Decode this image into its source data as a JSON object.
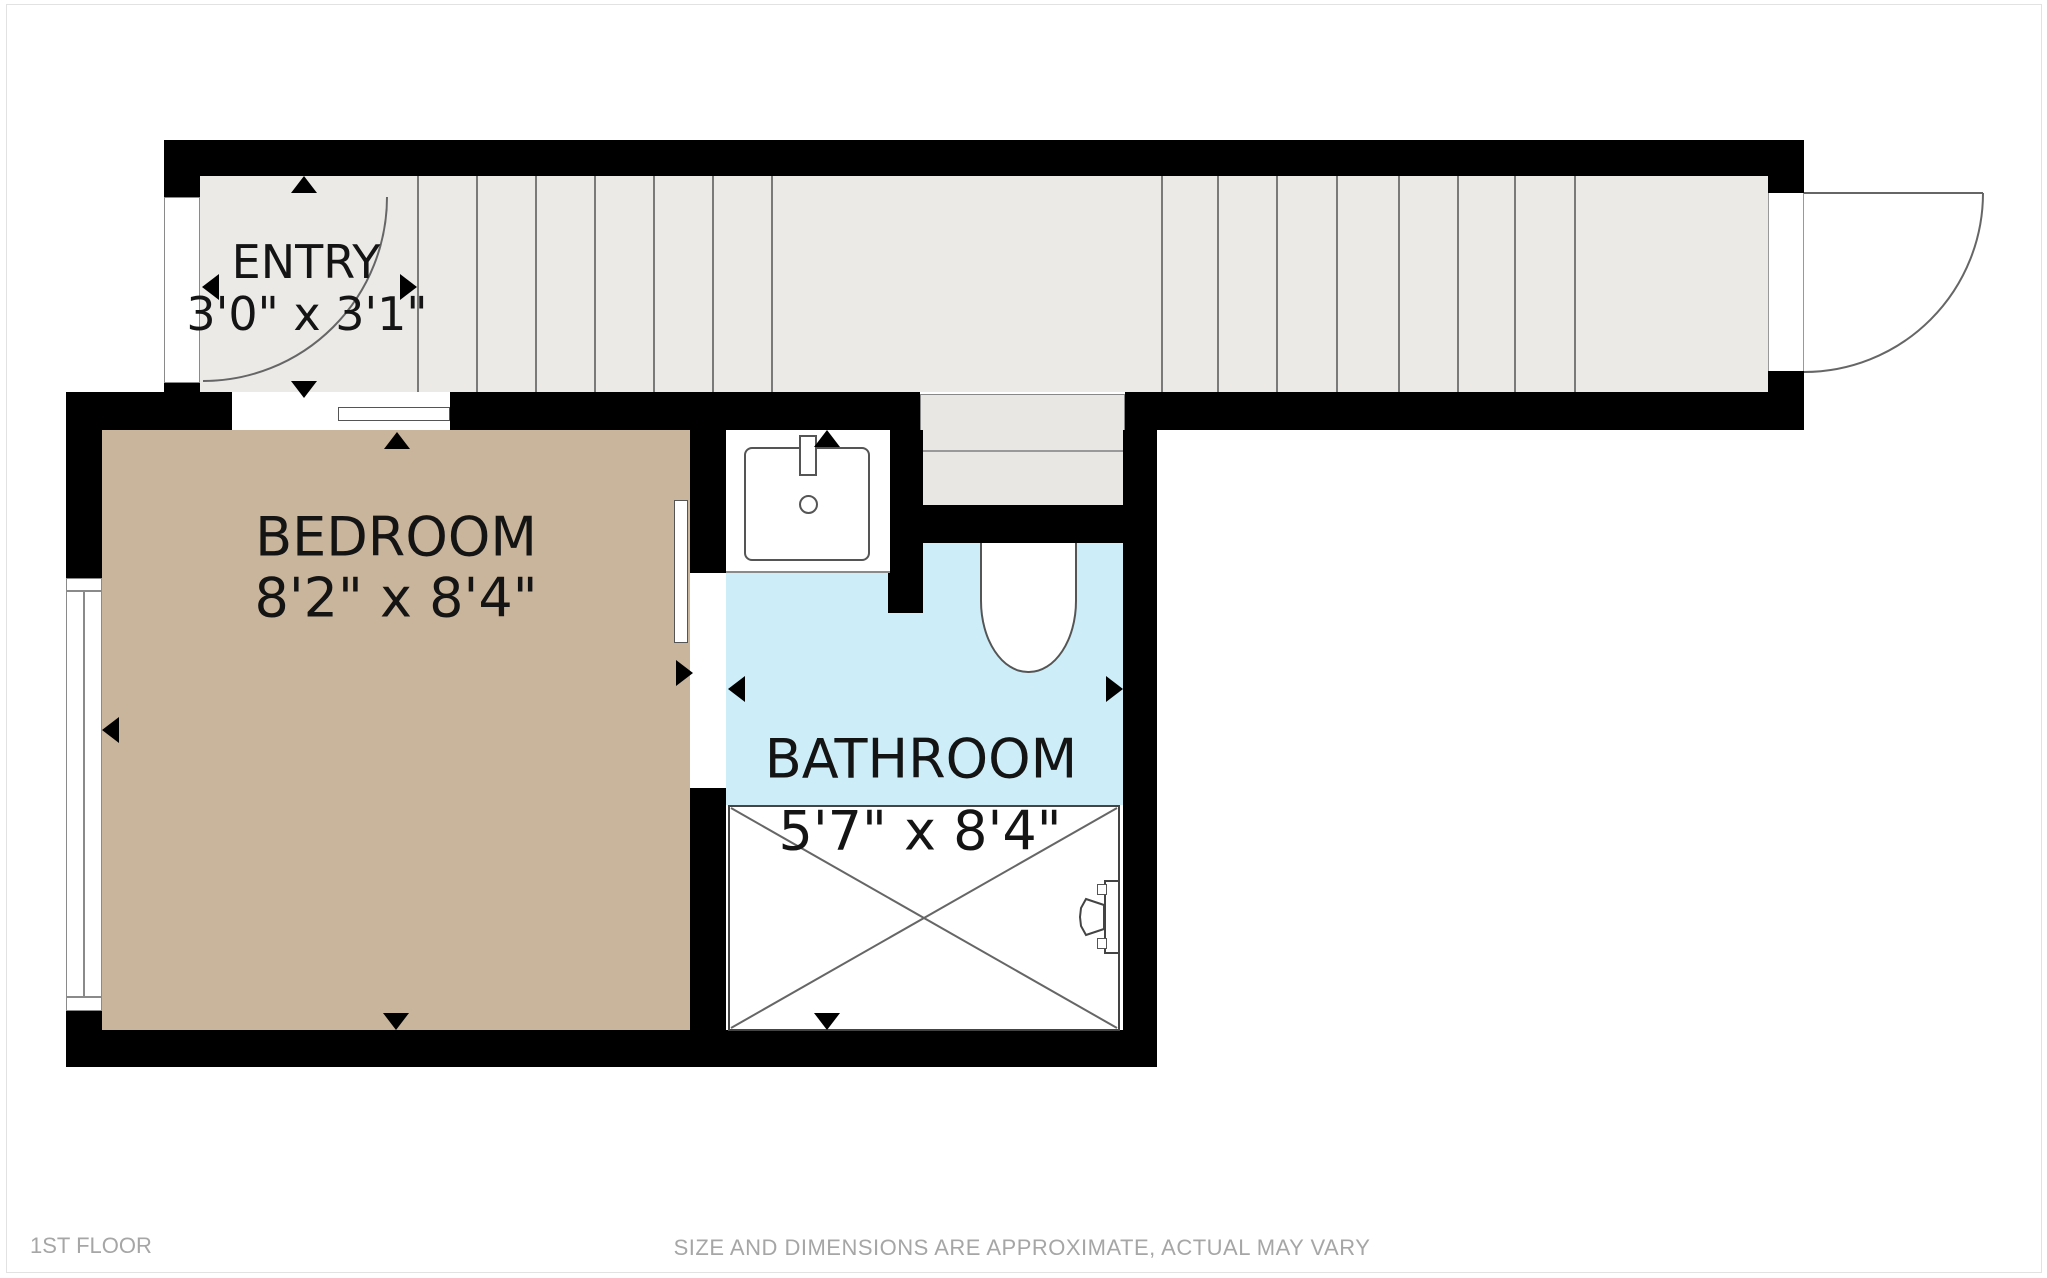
{
  "plan": {
    "rooms": [
      {
        "name": "ENTRY",
        "dims": "3'0\" x 3'1\""
      },
      {
        "name": "BEDROOM",
        "dims": "8'2\" x 8'4\""
      },
      {
        "name": "BATHROOM",
        "dims": "5'7\" x 8'4\""
      }
    ],
    "icons": [
      "stairs-icon",
      "entry-door-swing-icon",
      "exterior-door-swing-icon",
      "sliding-door-icon",
      "pocket-door-icon",
      "sink-icon",
      "toilet-icon",
      "shower-icon",
      "shower-valve-icon",
      "window-icon",
      "dimension-arrow-icon"
    ]
  },
  "footer": {
    "floor_label": "1ST FLOOR",
    "disclaimer": "SIZE AND DIMENSIONS ARE APPROXIMATE, ACTUAL MAY VARY"
  },
  "colors": {
    "bg": "#ffffff",
    "wall": "#000000",
    "corridor": "#eceae7",
    "bedroom": "#c9b49c",
    "bathroom": "#cdeef8",
    "steps": "#e8e7e4",
    "text": "#141414",
    "footer": "#a6a6a6",
    "frame": "#e2e2e2"
  }
}
